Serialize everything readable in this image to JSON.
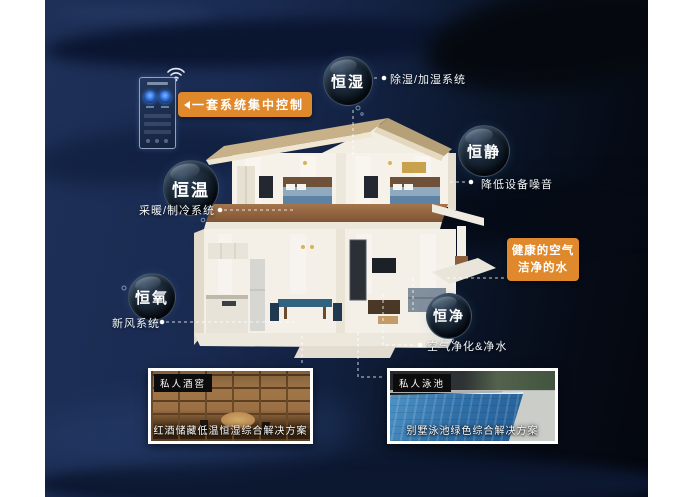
{
  "poster": {
    "control_callout": "一套系统集中控制",
    "healthy_callout": {
      "line1": "健康的空气",
      "line2": "洁净的水"
    }
  },
  "bubbles": [
    {
      "id": "constant-humidity",
      "label": "恒湿"
    },
    {
      "id": "constant-quiet",
      "label": "恒静"
    },
    {
      "id": "constant-temperature",
      "label": "恒温"
    },
    {
      "id": "constant-oxygen",
      "label": "恒氧"
    },
    {
      "id": "constant-purity",
      "label": "恒净"
    }
  ],
  "annotations": {
    "dehumidify": "除湿/加湿系统",
    "noise": "降低设备噪音",
    "hvac": "采暖/制冷系统",
    "fresh_air": "新风系统",
    "purification": "空气净化&净水"
  },
  "cards": [
    {
      "tag": "私人酒窖",
      "caption": "红酒储藏低温恒湿综合解决方案"
    },
    {
      "tag": "私人泳池",
      "caption": "别墅泳池绿色综合解决方案"
    }
  ],
  "icons": {
    "wifi": "wifi-icon",
    "panel": "smart-control-panel-icon",
    "arrow": "arrow-left-icon"
  },
  "colors": {
    "accent_orange": "#DF892C",
    "background_navy": "#14234A",
    "bubble_dark": "#0D1724",
    "roof_tan": "#C8B089"
  }
}
